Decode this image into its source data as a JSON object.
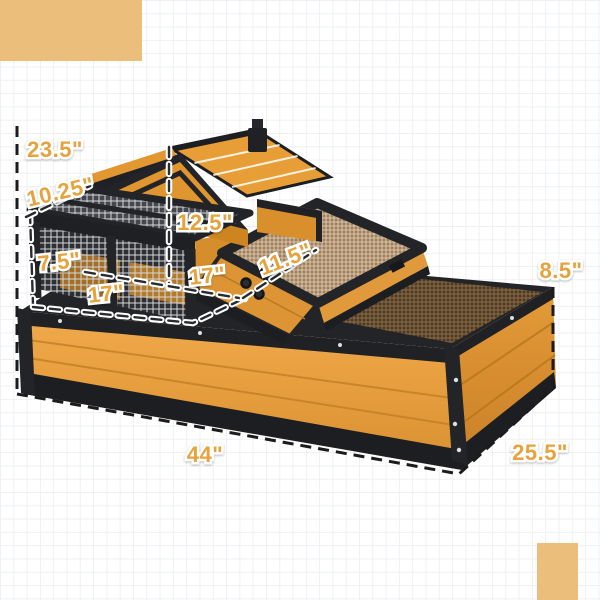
{
  "page": {
    "description": "Product dimension diagram of a two-level wooden small animal hutch with wire mesh run",
    "unit": "inches"
  },
  "labels": {
    "overall_height": "23.5\"",
    "roof_panel": "10.25\"",
    "house_height": "12.5\"",
    "run_height": "7.5\"",
    "run_width": "17\"",
    "house_width": "17\"",
    "platform_depth": "11.5\"",
    "base_height": "8.5\"",
    "overall_length": "44\"",
    "overall_depth": "25.5\""
  },
  "colors": {
    "label_text": "#E8A23B",
    "accent_square": "#ECBE7B",
    "wood_light": "#F0A94B",
    "wood_dark": "#D88F2F",
    "frame_black": "#212226",
    "mesh_silver": "#D4D6D9",
    "mesh_bronze": "#8E6C44",
    "grid_line": "#EEF0F3"
  }
}
